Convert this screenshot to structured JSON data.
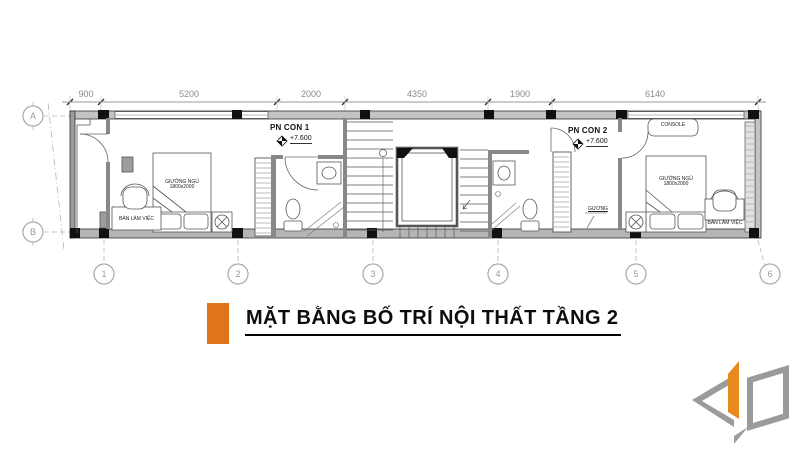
{
  "plan": {
    "grid": {
      "rows": [
        "A",
        "B"
      ],
      "cols": [
        "1",
        "2",
        "3",
        "4",
        "5",
        "6"
      ]
    },
    "dimensions_mm": [
      "900",
      "5200",
      "2000",
      "4350",
      "1900",
      "6140"
    ],
    "labels": {
      "room1_name": "PN CON 1",
      "room1_level": "+7.600",
      "room2_name": "PN CON 2",
      "room2_level": "+7.600",
      "console": "CONSOLE",
      "bed_left_name": "GIƯỜNG NGỦ",
      "bed_left_size": "1800x2000",
      "desk_left": "BÀN LÀM VIỆC",
      "bed_right_name": "GIƯỜNG NGỦ",
      "bed_right_size": "1800x2000",
      "desk_right": "BÀN LÀM VIỆC",
      "mirror": "GƯƠNG"
    }
  },
  "title": {
    "text": "MẶT BẰNG BỐ TRÍ NỘI THẤT TẦNG 2",
    "accent_color": "#DE751B"
  },
  "logo": {
    "accent_color": "#E8891D",
    "gray_color": "#9b9b9d"
  }
}
